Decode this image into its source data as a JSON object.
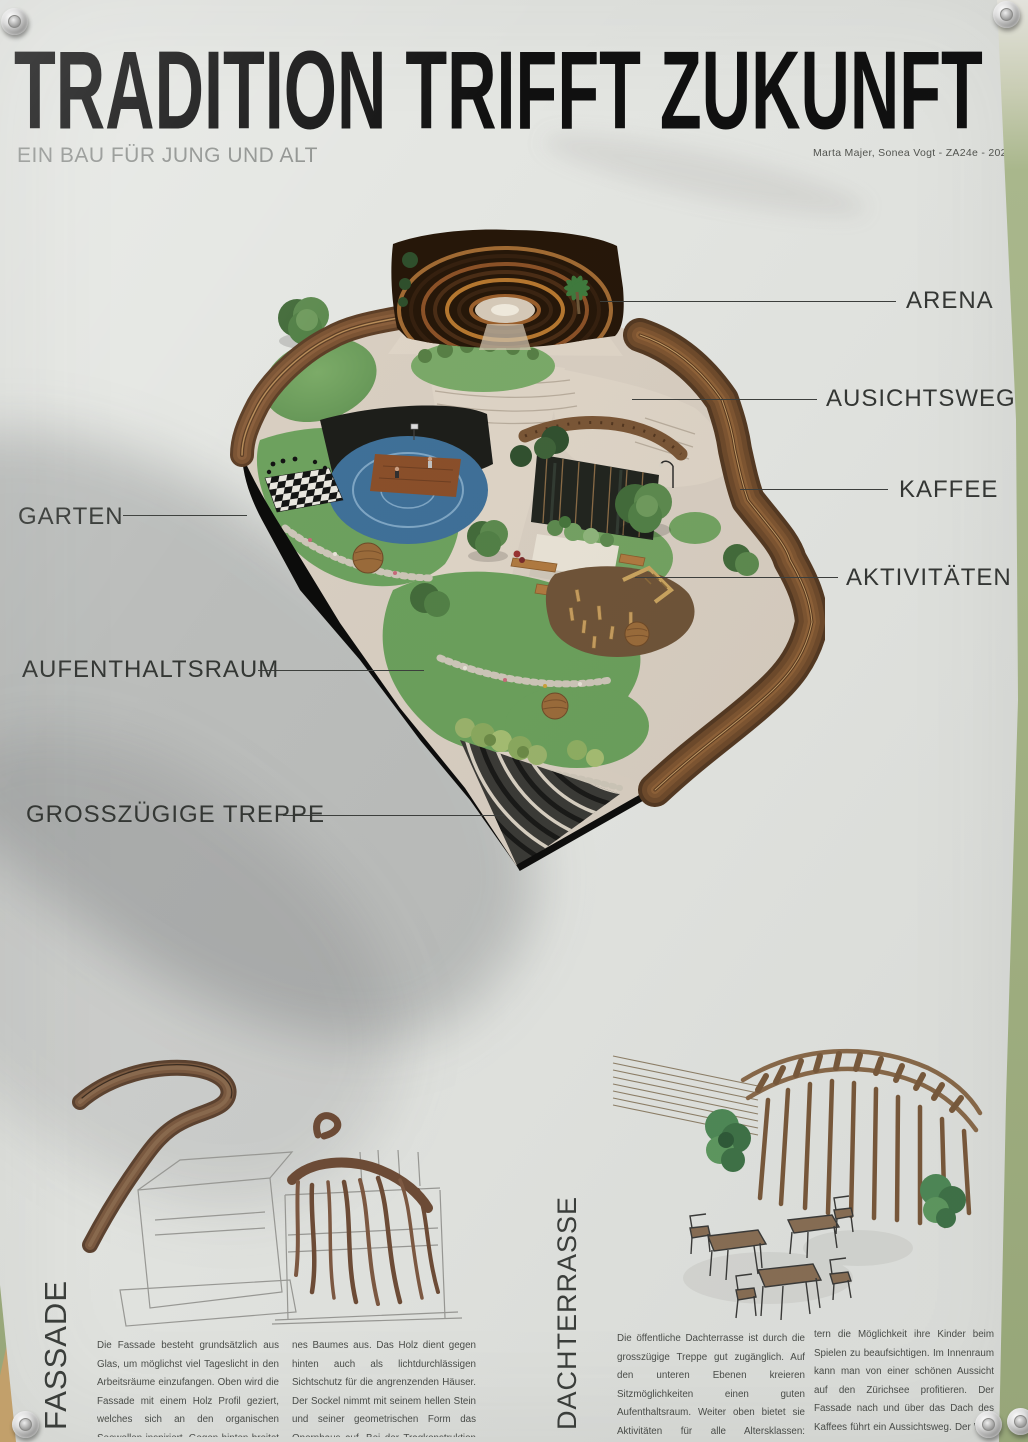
{
  "poster": {
    "title": "TRADITION TRIFFT ZUKUNFT",
    "subtitle": "EIN BAU FÜR JUNG UND ALT",
    "attribution": "Marta Majer, Sonea Vogt  -  ZA24e  -  2026",
    "callouts": {
      "arena": "ARENA",
      "ausichtsweg": "AUSICHTSWEG",
      "kaffee": "KAFFEE",
      "aktivitaeten": "AKTIVITÄTEN",
      "garten": "GARTEN",
      "aufenthaltsraum": "AUFENTHALTSRAUM",
      "treppe": "GROSSZÜGIGE TREPPE"
    },
    "sections": {
      "fassade": {
        "heading": "FASSADE",
        "col1": "Die Fassade besteht grundsätzlich aus Glas, um möglichst viel Tageslicht in den Arbeitsräume einzufangen. Oben wird die Fassade mit einem Holz Profil geziert, welches sich an den organischen Seewellen inspiriert. Gegen hinten breitet sich das Holz wie die Wurzeln ei-",
        "col2": "nes Baumes aus. Das Holz dient gegen hinten auch als lichtdurchlässigen Sichtschutz für die angrenzenden Häuser. Der Sockel nimmt mit seinem hellen Stein und seiner geometrischen Form das Opernhaus auf. Bei der Tragkonstruktion wird sehr auf Nachhaltigkeit geachtet."
      },
      "dachterrasse": {
        "heading": "DACHTERRASSE",
        "col1": "Die öffentliche Dachterrasse ist durch die grosszügige Treppe gut zugänglich. Auf den unteren Ebenen kreieren Sitzmöglichkeiten einen guten Aufenthaltsraum. Weiter oben bietet sie Aktivitäten für alle Altersklassen: Basketball, Schach und ein Spielpatz. Oberhalb befindet sich ein gemütliches Kaffee. Es gibt El-",
        "col2": "tern die Möglichkeit ihre Kinder beim Spielen zu beaufsichtigen. Im Innenraum kann man von einer schönen Aussicht auf den Zürichsee profitieren. Der Fassade nach und über das Dach des Kaffees führt ein Aussichtsweg. Der Weg dient nicht nur zur Aussicht, sondern auch als direktem Zugang zur Freiluftarena."
      }
    },
    "colors": {
      "wall_green": "#9fae80",
      "paper": "#e4e6e2",
      "wood_rim": "#6e4a2b",
      "lawn": "#6ba05c",
      "court_blue": "#3f7098",
      "ink": "#343734"
    }
  }
}
